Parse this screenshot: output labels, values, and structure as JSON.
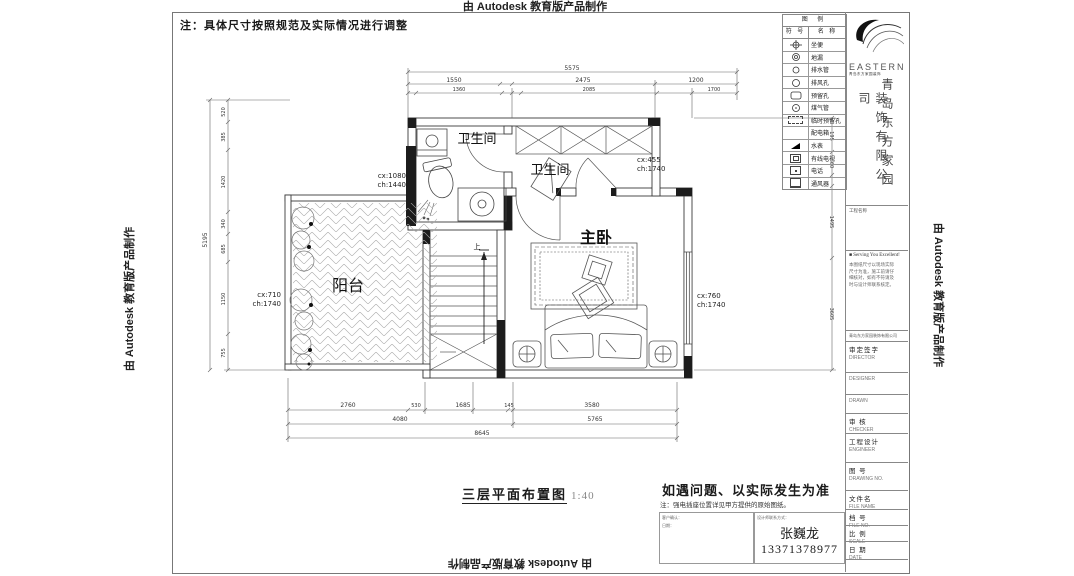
{
  "watermarks": {
    "text": "由 Autodesk 教育版产品制作"
  },
  "note_top": "注：具体尺寸按照规范及实际情况进行调整",
  "plan": {
    "rooms": {
      "bathroom1": "卫生间",
      "bathroom2": "卫生间",
      "master": "主卧",
      "balcony": "阳台"
    },
    "stair_up": "上",
    "annotations": [
      {
        "l1": "cx:1080",
        "l2": "ch:1440"
      },
      {
        "l1": "cx:455",
        "l2": "ch:1740"
      },
      {
        "l1": "cx:710",
        "l2": "ch:1740"
      },
      {
        "l1": "cx:760",
        "l2": "ch:1740"
      }
    ]
  },
  "dims": {
    "top": {
      "total": "5575",
      "row2": [
        "1550",
        "2475",
        "1200"
      ],
      "row3": [
        "1360",
        "2085",
        "1700"
      ]
    },
    "bottom": {
      "row1": [
        "2760",
        "530",
        "1685",
        "145",
        "3580"
      ],
      "row2": [
        "4080",
        "5765"
      ],
      "total": "8645"
    },
    "left": {
      "total": "5195",
      "segs": [
        "520",
        "385",
        "1420",
        "340",
        "685",
        "1150",
        "755"
      ]
    },
    "right": {
      "segs": [
        "195",
        "60",
        "1495",
        "3605"
      ]
    }
  },
  "legend": {
    "title": "图 例",
    "col_symbol": "符 号",
    "col_name": "名 称",
    "rows": [
      {
        "name": "坐便"
      },
      {
        "name": "地漏"
      },
      {
        "name": "排水管"
      },
      {
        "name": "排风孔"
      },
      {
        "name": "预留孔"
      },
      {
        "name": "煤气管"
      },
      {
        "name": "临时预留孔"
      },
      {
        "name": "配电箱"
      },
      {
        "name": "水表"
      },
      {
        "name": "有线电视"
      },
      {
        "name": "电话"
      },
      {
        "name": "通风器"
      }
    ]
  },
  "brand": {
    "logo": "EASTERN",
    "logo_sub": "青岛东方家园装饰",
    "company_col_right": "青岛东方家园",
    "company_col_left": "装饰有限公司"
  },
  "titleblock": {
    "project_label": "工程名称",
    "slogan": "■ Serving You Excellent!",
    "notes": [
      "本图纸尺寸以现场实际",
      "尺寸为准，施工前请仔",
      "细核对，如有不符请及",
      "时与设计师联系核定。"
    ],
    "address_line": "青岛东方家园装饰有限公司",
    "rows": [
      {
        "cn": "审定签字",
        "en": "DIRECTOR"
      },
      {
        "cn": "",
        "en": "DESIGNER"
      },
      {
        "cn": "",
        "en": "DRAWN"
      },
      {
        "cn": "审 核",
        "en": "CHECKER"
      },
      {
        "cn": "工程设计",
        "en": "ENGINEER"
      },
      {
        "cn": "图 号",
        "en": "DRAWING NO."
      },
      {
        "cn": "文件名",
        "en": "FILE NAME"
      },
      {
        "cn": "档 号",
        "en": "FILE NO."
      },
      {
        "cn": "比 例",
        "en": "SCALE"
      },
      {
        "cn": "日 期",
        "en": "DATE"
      }
    ]
  },
  "footer": {
    "drawing_title": "三层平面布置图",
    "scale": "1:40",
    "warn_title": "如遇问题、以实际发生为准",
    "warn_note": "注：强电插座位置详见甲方提供的原始图纸。",
    "box1_line1": "客户确认：",
    "box1_line2": "日期：",
    "box2_header": "设计师联系方式：",
    "designer_name": "张巍龙",
    "designer_phone": "13371378977"
  }
}
